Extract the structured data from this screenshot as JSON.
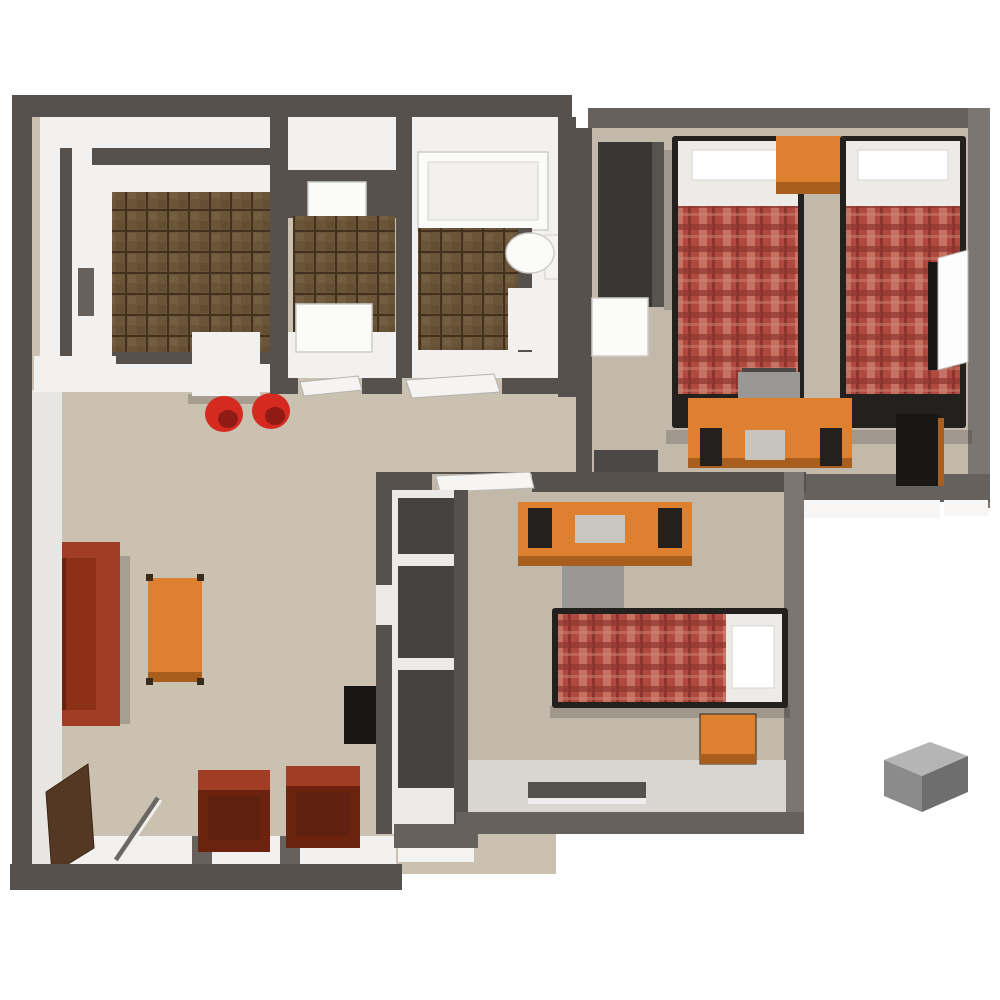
{
  "canvas": {
    "width": 1000,
    "height": 1000
  },
  "palette": {
    "wall_dark": "#56514d",
    "wall_mid": "#66615d",
    "wall_light": "#7b7672",
    "floor_living": "#cac1b1",
    "floor_bedroom": "#c2b9ab",
    "floor_tile_base": "#6b5538",
    "tile_grout": "#42311d",
    "counter_white": "#f2f1ef",
    "fixture_white": "#fbfbfa",
    "plaid_base": "#b0493f",
    "plaid_light": "#cf8273",
    "plaid_dark": "#8c352d",
    "pillow_white": "#ecebe7",
    "wood_orange": "#dd8130",
    "wood_orange_dark": "#a85f1e",
    "couch_red": "#8c3018",
    "couch_red_dark": "#6b2310",
    "couch_red_light": "#a03d24",
    "stool_red": "#d52a20",
    "chair_grey": "#9a9894",
    "chair_dark": "#4a4845",
    "black": "#191715",
    "bookcase_brown": "#553823",
    "box_grey_top": "#b5b5b5",
    "box_grey_front": "#8b8b8b",
    "box_grey_side": "#6e6e6e",
    "shadow": "rgba(40,35,30,0.22)"
  },
  "scene": {
    "type": "3d-floor-plan",
    "view": "top-down-isometric",
    "rooms": [
      {
        "name": "kitchen",
        "floor": "brown-tile"
      },
      {
        "name": "laundry-closet",
        "floor": "brown-tile"
      },
      {
        "name": "bathroom",
        "floor": "brown-tile"
      },
      {
        "name": "bedroom-top-right",
        "floor": "tan"
      },
      {
        "name": "bedroom-center",
        "floor": "tan"
      },
      {
        "name": "living-room",
        "floor": "tan"
      },
      {
        "name": "hallway",
        "floor": "tan"
      },
      {
        "name": "closet-shelved",
        "floor": "white"
      }
    ],
    "furniture": [
      "kitchen-island",
      "bar-stool",
      "bar-stool",
      "washer",
      "dryer",
      "bathtub",
      "toilet",
      "vanity",
      "wardrobe",
      "mini-fridge",
      "twin-bed-plaid",
      "twin-bed-plaid",
      "nightstand",
      "desk",
      "desk-chair",
      "dresser",
      "open-door",
      "desk",
      "desk-chair",
      "twin-bed-plaid",
      "nightstand",
      "closet-shelves",
      "wall-tv",
      "sofa",
      "coffee-table",
      "armchair",
      "armchair",
      "bookcase",
      "hall-bench",
      "outdoor-utility-box"
    ]
  }
}
